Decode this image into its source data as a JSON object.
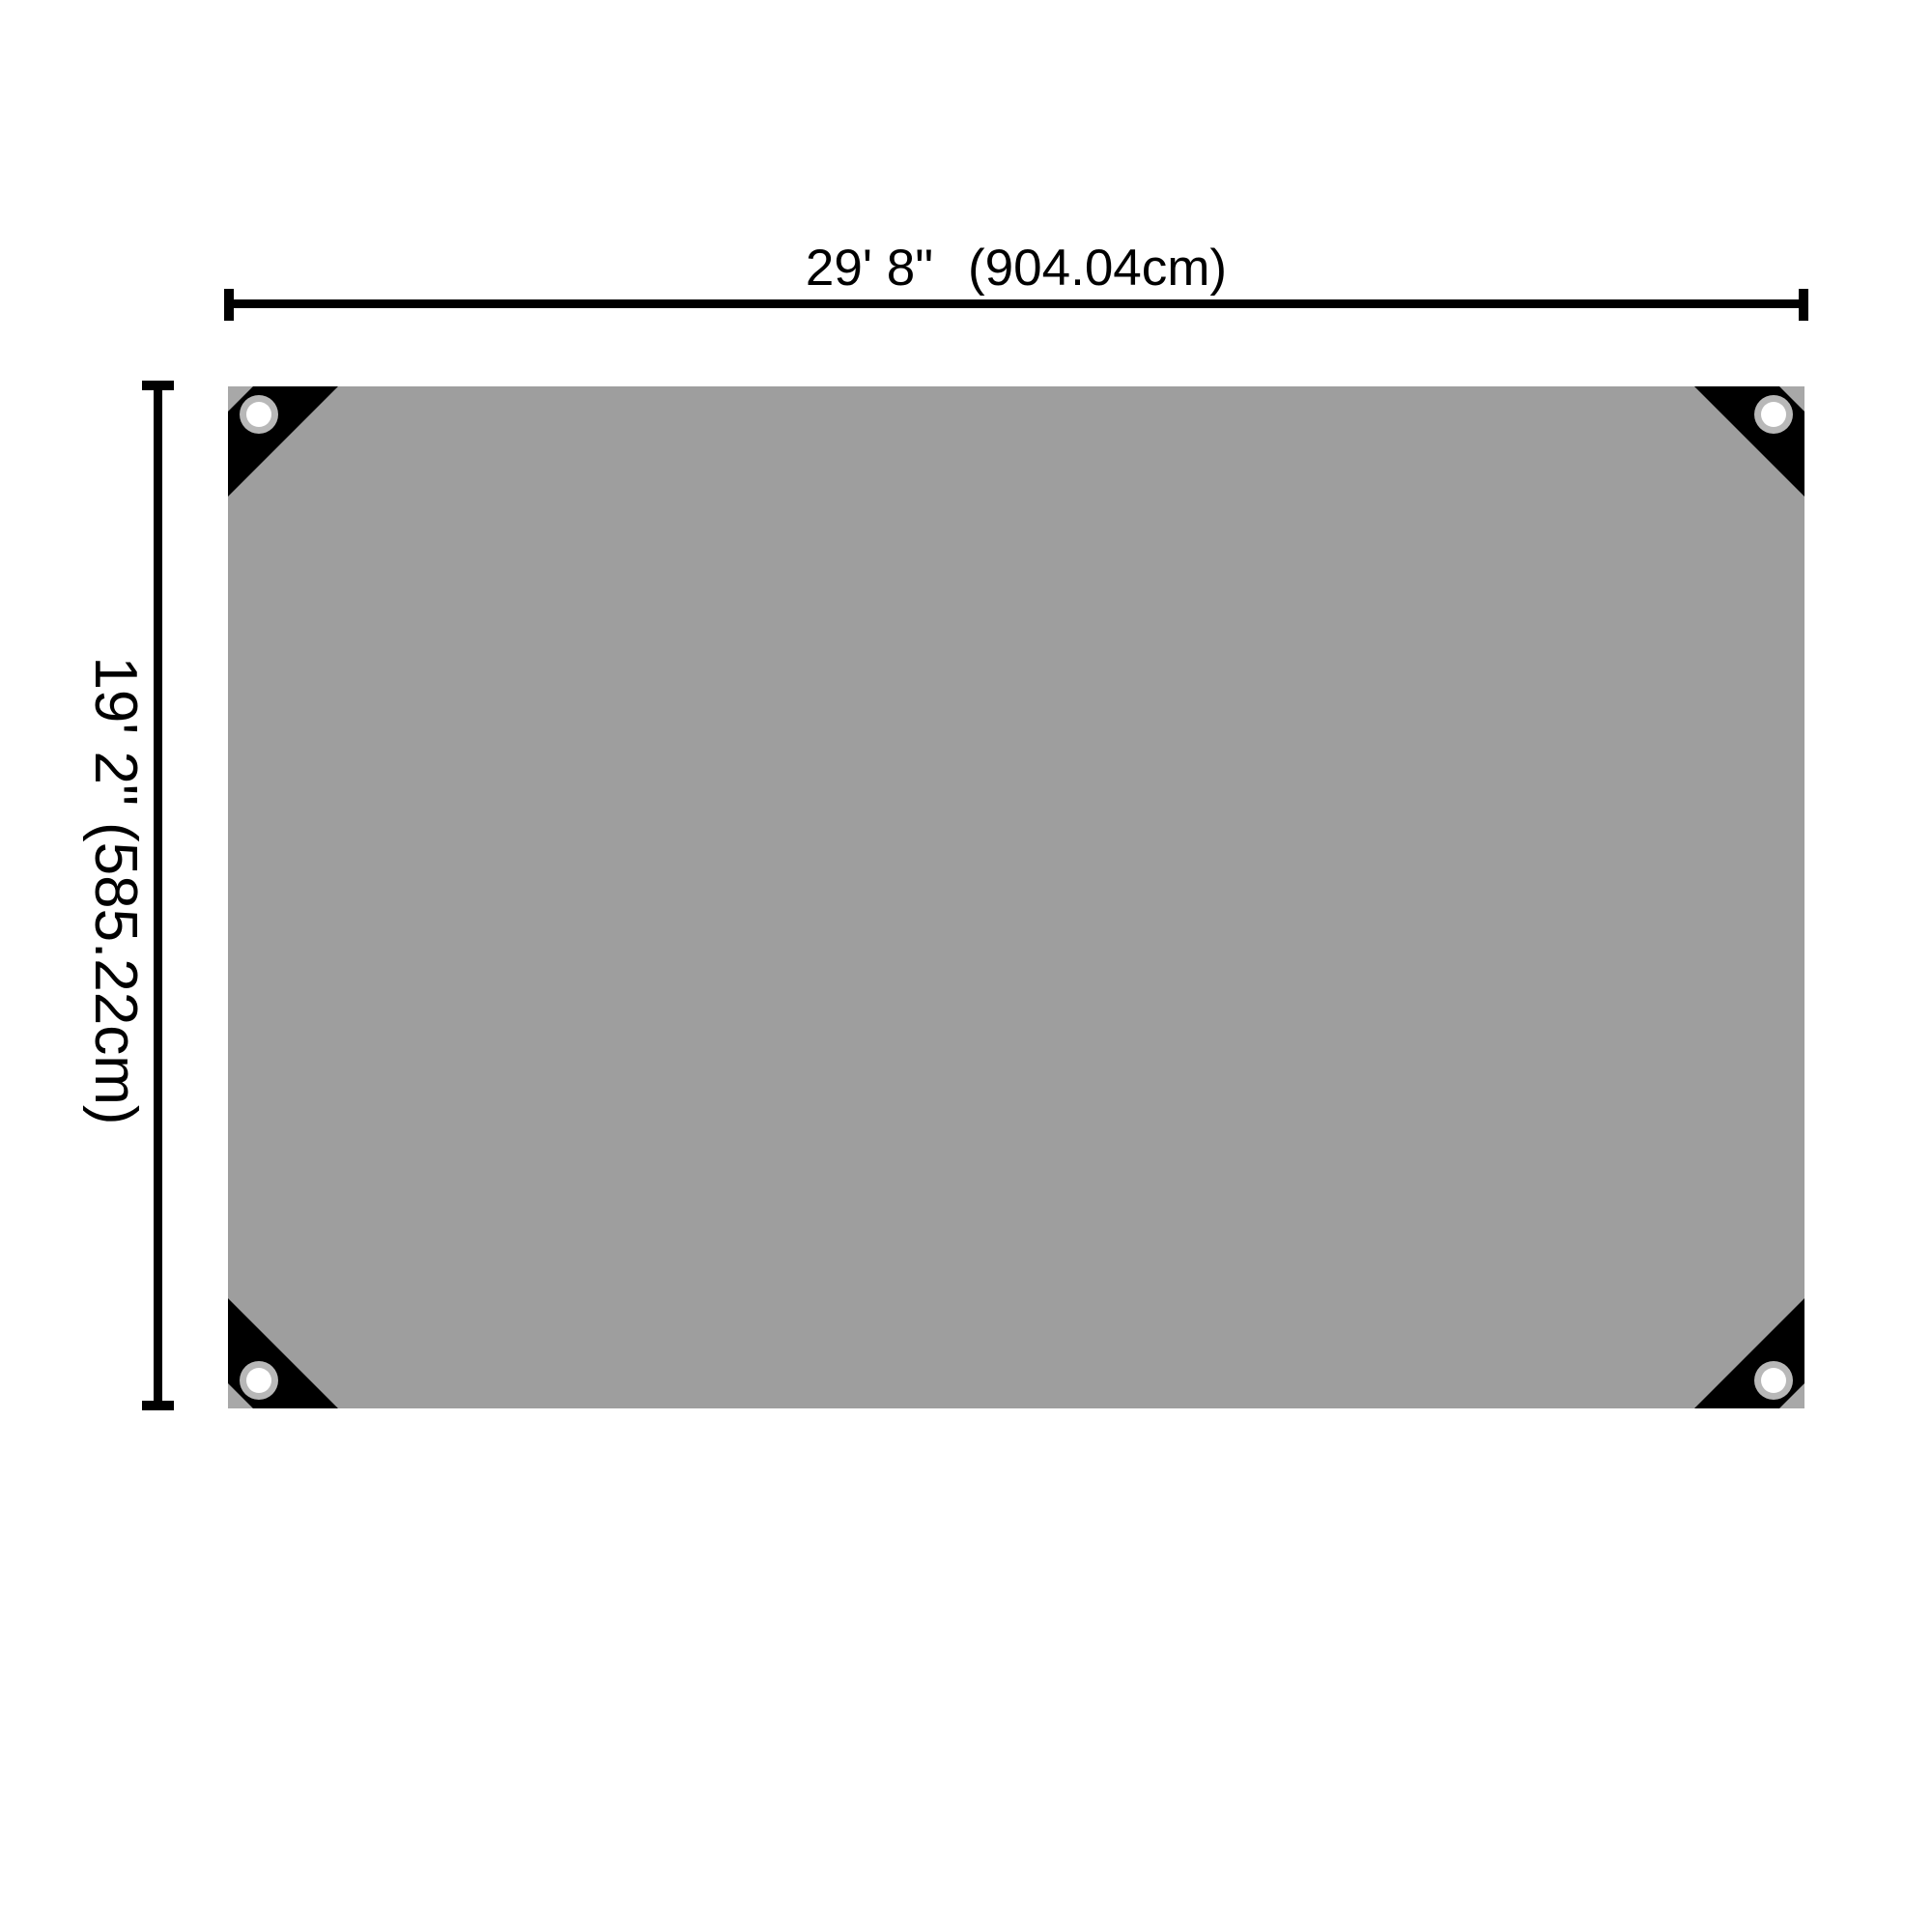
{
  "diagram": {
    "type": "product-dimension-diagram",
    "subject": "tarpaulin-top-view",
    "grommet_count": 4,
    "width_dimension": {
      "imperial": "29' 8\"",
      "metric": "(904.04cm)"
    },
    "height_dimension": {
      "imperial": "19' 2\"",
      "metric": "(585.22cm)"
    }
  },
  "colors": {
    "background": "#FFFFFF",
    "tarp": "#9E9E9E",
    "corner_patch": "#000000",
    "corner_notch": "#A8A8A8",
    "grommet_ring": "#B8B8B8",
    "grommet_hole": "#FFFFFF",
    "dimension_line": "#000000",
    "label_text": "#000000"
  }
}
